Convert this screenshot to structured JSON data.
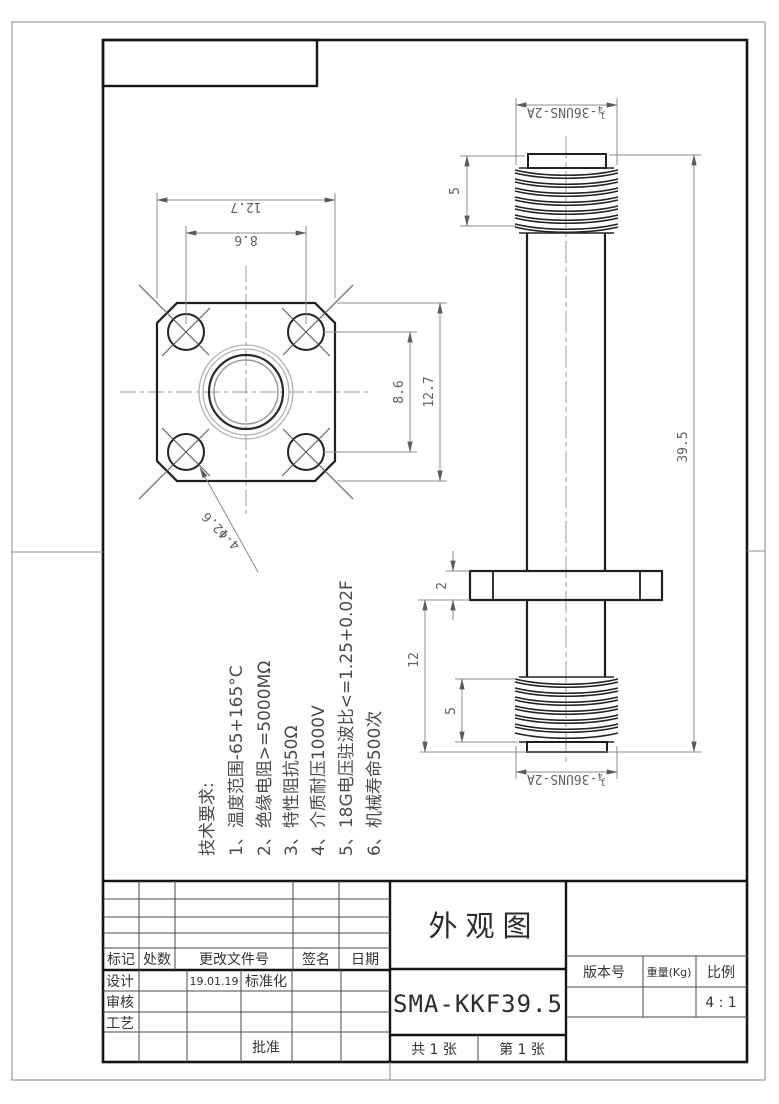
{
  "title_block": {
    "drawing_title": "外观图",
    "part_number": "SMA-KKF39.5",
    "sheet_total": "共 1 张",
    "sheet_page": "第 1 张",
    "version_label": "版本号",
    "weight_label": "重量(Kg)",
    "scale_label": "比例",
    "scale_value": "4 : 1"
  },
  "revision_table": {
    "headers": [
      "标记",
      "处数",
      "更改文件号",
      "签名",
      "日期"
    ]
  },
  "approval": {
    "design": "设计",
    "design_date": "19.01.19",
    "standardization": "标准化",
    "check": "审核",
    "process": "工艺",
    "approve": "批准"
  },
  "tech_requirements": {
    "heading": "技术要求:",
    "items": [
      "1、温度范围-65+165°C",
      "2、绝缘电阻>=5000MΩ",
      "3、特性阻抗50Ω",
      "4、介质耐压1000V",
      "5、18G电压驻波比<=1.25+0.02F",
      "6、机械寿命500次"
    ]
  },
  "dimensions": {
    "front": {
      "width": "12.7",
      "hole_span_x": "8.6",
      "hole_span_y": "8.6",
      "height": "12.7",
      "holes": "4-Φ2.6"
    },
    "side": {
      "thread_top": "¼-36UNS-2A",
      "thread_top_length": "5",
      "overall_length": "39.5",
      "flange_thickness": "2",
      "flange_to_end": "12",
      "thread_bottom_length": "5",
      "thread_bottom": "¼-36UNS-2A"
    }
  }
}
